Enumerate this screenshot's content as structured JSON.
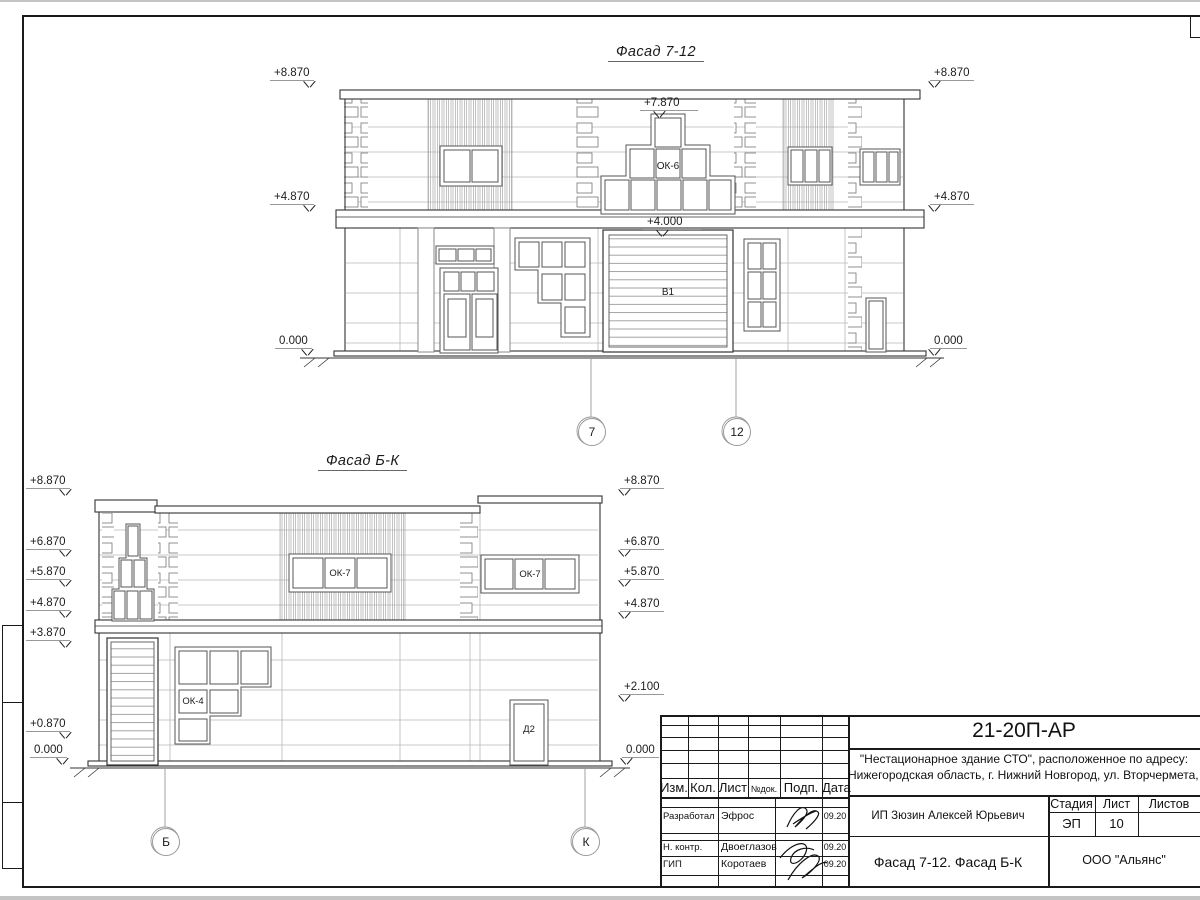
{
  "facade1": {
    "title": "Фасад 7-12",
    "marks_left": [
      "+8.870",
      "+4.870",
      "0.000"
    ],
    "marks_right": [
      "+8.870",
      "+4.870",
      "0.000"
    ],
    "mark_top": "+7.870",
    "mark_gate": "+4.000",
    "labels": {
      "window": "ОК-6",
      "gate": "В1"
    },
    "axis_left": "7",
    "axis_right": "12"
  },
  "facade2": {
    "title": "Фасад Б-К",
    "marks_left": [
      "+8.870",
      "+6.870",
      "+5.870",
      "+4.870",
      "+3.870",
      "+0.870",
      "0.000"
    ],
    "marks_right": [
      "+8.870",
      "+6.870",
      "+5.870",
      "+4.870",
      "+2.100",
      "0.000"
    ],
    "labels": {
      "window_left": "ОК-7",
      "window_right": "ОК-7",
      "window_low": "ОК-4",
      "door": "Д2"
    },
    "axis_left": "Б",
    "axis_right": "К"
  },
  "titleblock": {
    "doc_number": "21-20П-АР",
    "project_line1": "\"Нестационарное здание СТО\", расположенное по адресу:",
    "project_line2": "Нижегородская область, г. Нижний Новгород, ул. Вторчермета, 1А",
    "header": {
      "izm": "Изм.",
      "kol": "Кол.",
      "list": "Лист",
      "ndok": "№док.",
      "podp": "Подп.",
      "data": "Дата"
    },
    "rows": [
      {
        "role": "Разработал",
        "name": "Эфрос",
        "date": "09.20"
      },
      {
        "role": "Н. контр.",
        "name": "Двоеглазов",
        "date": "09.20"
      },
      {
        "role": "ГИП",
        "name": "Коротаев",
        "date": "09.20"
      }
    ],
    "client": "ИП Зюзин Алексей Юрьевич",
    "sheet_title": "Фасад 7-12. Фасад Б-К",
    "stage_label": "Стадия",
    "list_label": "Лист",
    "listov_label": "Листов",
    "stage": "ЭП",
    "sheet_no": "10",
    "company": "ООО \"Альянс\""
  }
}
